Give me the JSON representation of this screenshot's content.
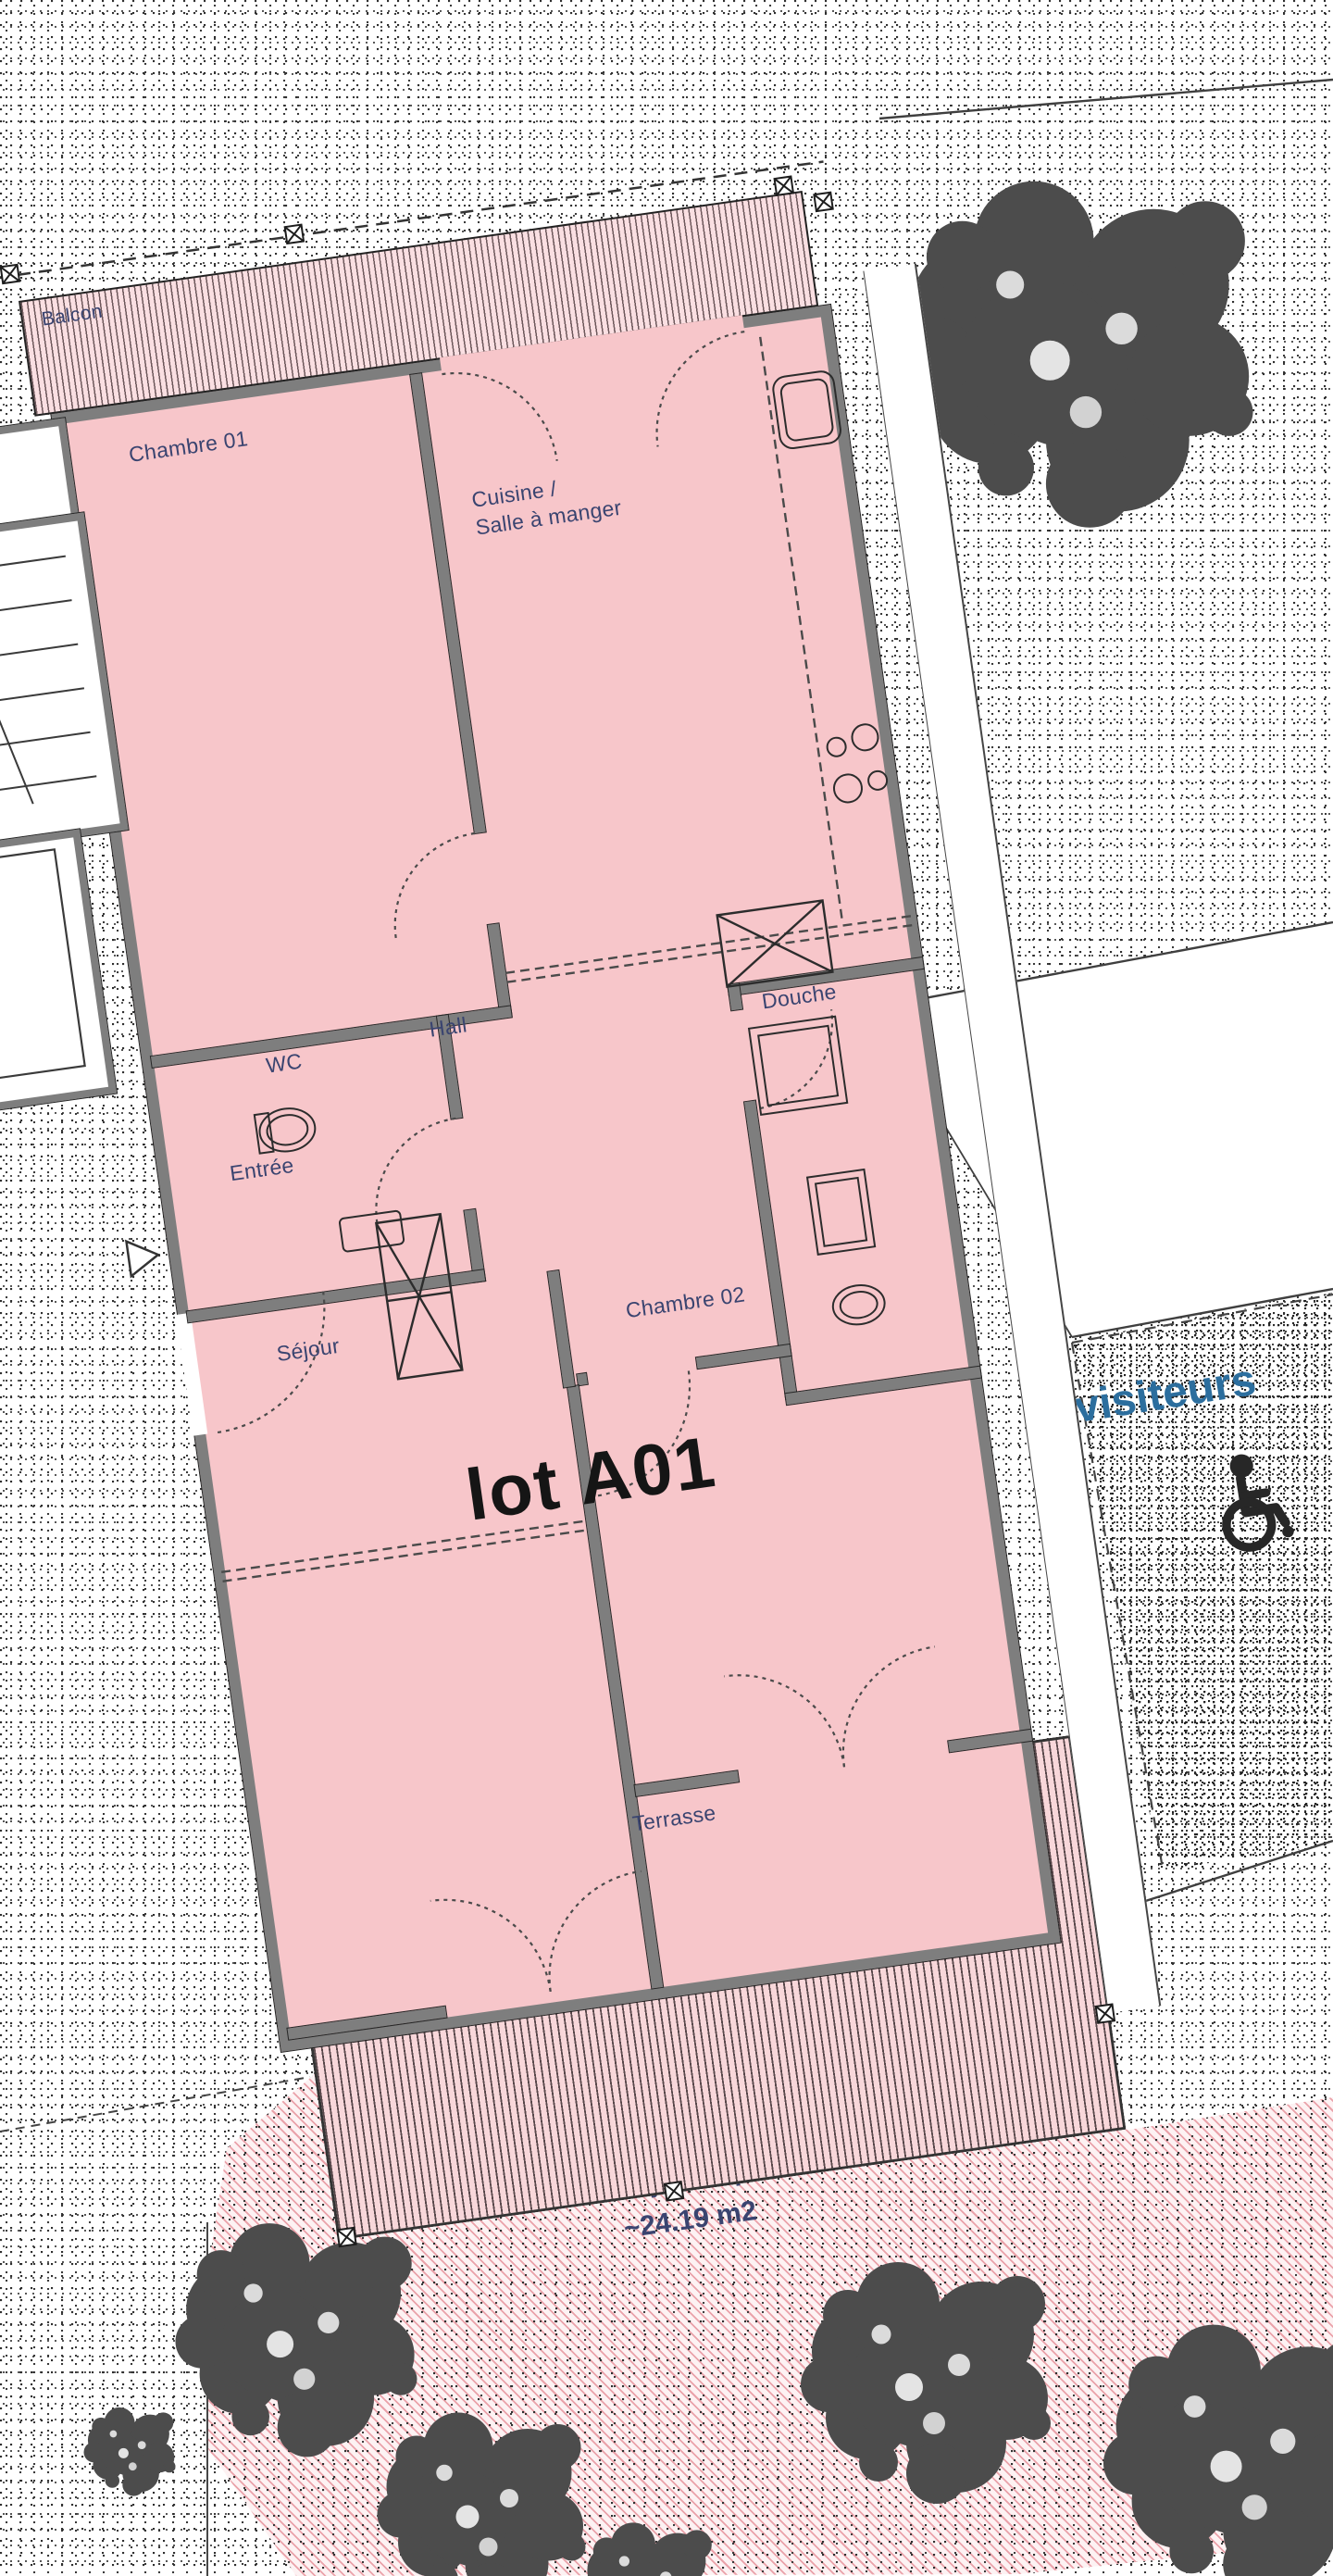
{
  "plan_title": "lot A01",
  "rooms": {
    "balcon": "Balcon",
    "chambre01": "Chambre 01",
    "cuisine_line1": "Cuisine /",
    "cuisine_line2": "Salle à manger",
    "wc": "WC",
    "hall": "Hall",
    "douche": "Douche",
    "entree": "Entrée",
    "sejour": "Séjour",
    "chambre02": "Chambre 02",
    "terrasse": "Terrasse"
  },
  "site": {
    "visitors_label": "visiteurs",
    "garden_label_line1": "surface jardin privatif",
    "garden_label_line2": "~24.19 m2"
  },
  "icons": {
    "wheelchair": "wheelchair-accessible-parking-icon",
    "tree": "tree-canopy-icon",
    "entrance_arrow": "entrance-arrow-icon",
    "boundary_post": "boundary-post-icon"
  },
  "colors": {
    "room_fill": "#f7c6ca",
    "hatch_pink": "#f8d7da",
    "wall_gray": "#7e7e7e",
    "label_blue": "#3a4470",
    "lot_text": "#151515",
    "visitors_blue": "#2c6e9e",
    "tree_gray": "#4c4c4c",
    "line_dark": "#3f3f3f"
  }
}
